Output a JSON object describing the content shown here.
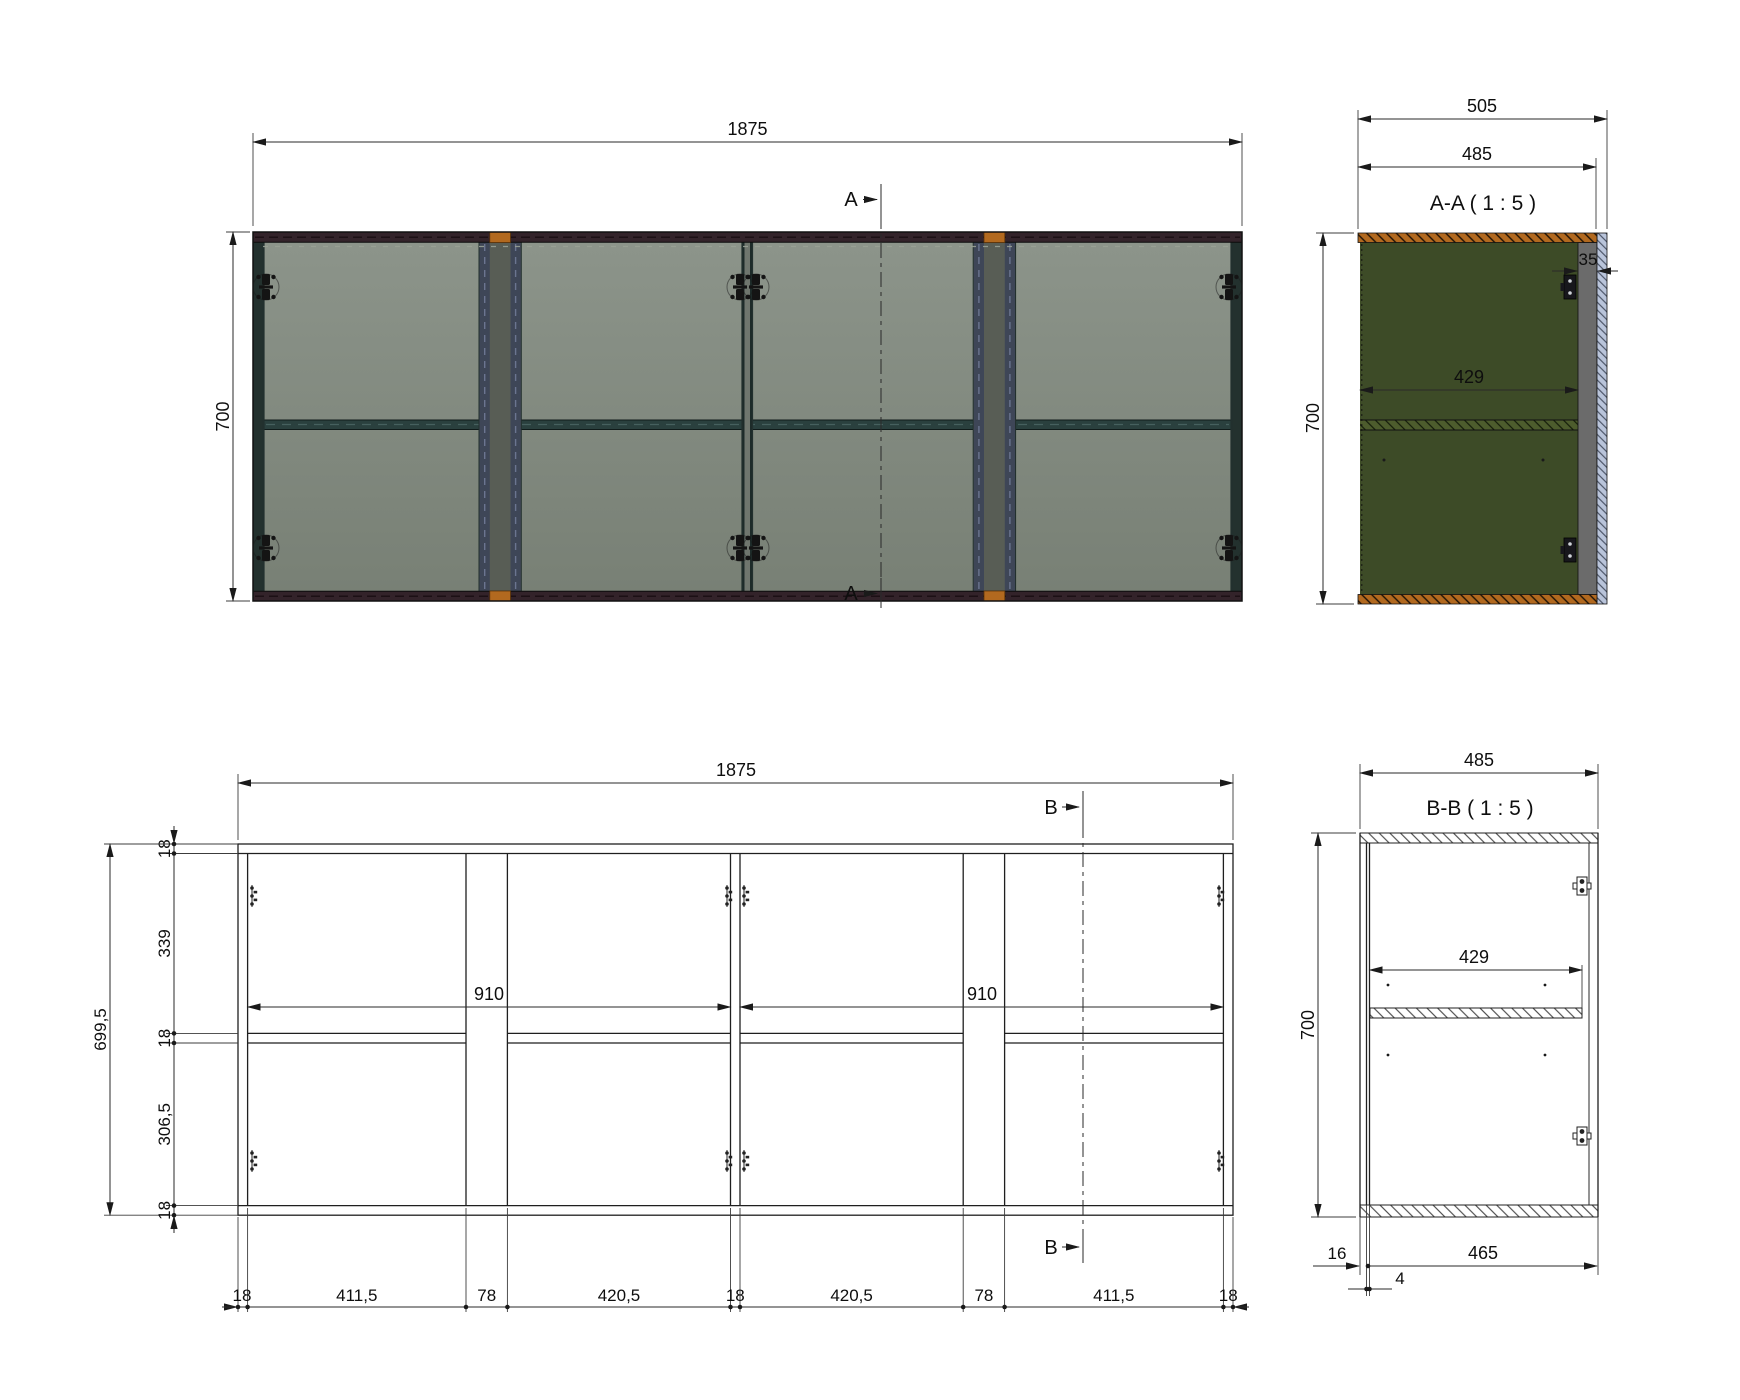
{
  "drawing": {
    "top_view": {
      "width_label": "1875",
      "height_label": "700",
      "section_marker": "A"
    },
    "section_aa": {
      "title": "A-A ( 1 : 5 )",
      "overall_width": "505",
      "carcass_width": "485",
      "height": "700",
      "interior_width": "429",
      "side_offset": "35"
    },
    "front_elevation": {
      "width_label": "1875",
      "overall_height": "699,5",
      "left_chain": [
        "18",
        "339",
        "18",
        "306,5",
        "18"
      ],
      "shelf_span_left": "910",
      "shelf_span_right": "910",
      "bottom_chain": [
        "18",
        "411,5",
        "78",
        "420,5",
        "18",
        "420,5",
        "78",
        "411,5",
        "18"
      ],
      "section_marker": "B"
    },
    "section_bb": {
      "title": "B-B ( 1 : 5 )",
      "carcass_width": "485",
      "height": "700",
      "interior_width": "429",
      "back_panel_thickness": "16",
      "back_gap": "4",
      "interior_depth": "465"
    }
  },
  "colors": {
    "line": "#1f1f1f",
    "glass_light": "#8c948a",
    "glass_dark": "#788075",
    "rail_dark": "#33232a",
    "edge_teal": "#23312e",
    "divider_blue": "#3e4657",
    "divider_gap": "#585d55",
    "shelf_teal": "#2a403e",
    "accent_orange": "#b2691f",
    "section_green": "#3d4b27",
    "shelf_green_aa": "#4d5c2d",
    "section_gray": "#6b6b6b",
    "section_blue": "#b9c4da"
  }
}
